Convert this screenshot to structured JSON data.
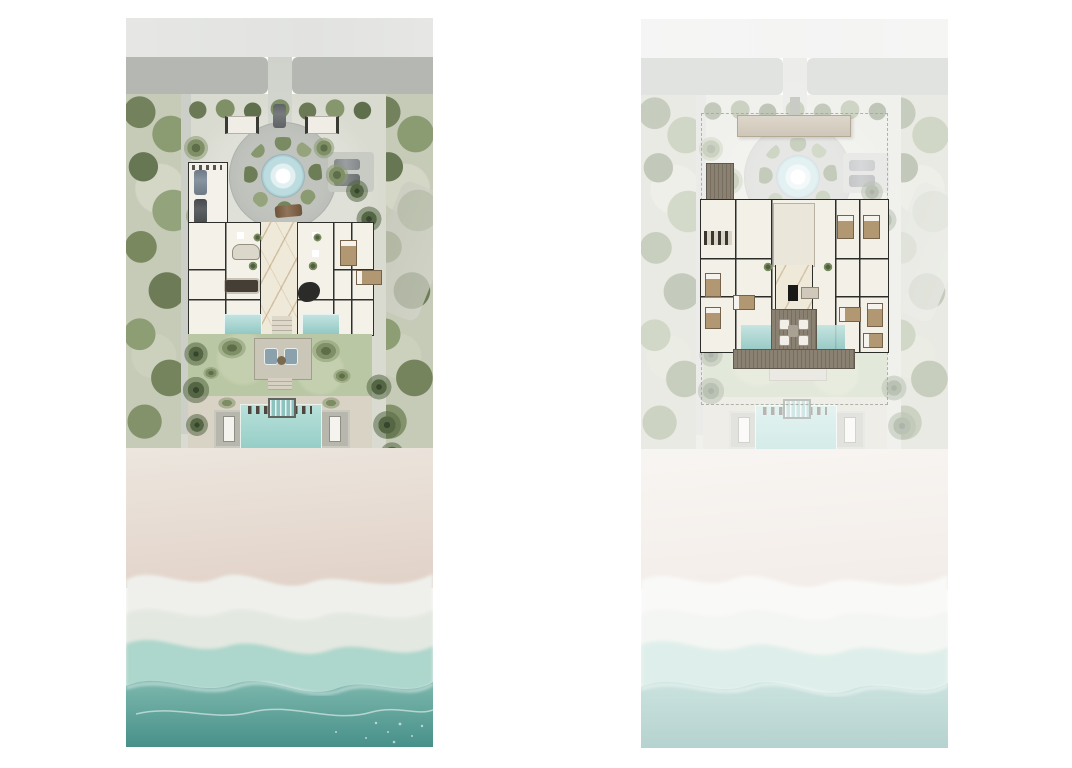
{
  "page": {
    "background": "#ffffff",
    "title": "Beachfront villa aerial site plan — ground floor and upper floor"
  },
  "panels": [
    {
      "id": "ground",
      "label": "Ground floor site plan",
      "description": "Full-colour aerial plan: access road, gated driveway, circular motor court with fountain, garage and parked cars, ground-floor villa with marble hall and reflecting pools, lawn with garden pavilion, beachfront pool with cabanas, palm trees, sand and surf."
    },
    {
      "id": "upper",
      "label": "Upper floor site plan",
      "description": "Same site shown faded with the upper-floor plan highlighted: entry canopy, timber decks, bedroom wings around the double-height hall, media room and roof terrace overlooking the pool garden; dashed property line."
    }
  ],
  "features": [
    "access-road",
    "driveway",
    "entry-gates",
    "motor-court",
    "fountain",
    "parking-pad",
    "garage",
    "villa-floorplan",
    "marble-hall",
    "reflecting-pools",
    "dining-table",
    "grand-piano",
    "bedrooms",
    "lawn",
    "garden-pavilion",
    "beach-pool",
    "spa",
    "pool-cabanas",
    "palm-trees",
    "beach-sand",
    "surf-foam",
    "ocean",
    "entry-canopy",
    "timber-decks",
    "roof-terrace",
    "property-line"
  ],
  "palette": {
    "road_band": "#b5b8b2",
    "forest": "#c6cbb8",
    "compound": "#d9dbd1",
    "paver": "#c1c4be",
    "fountain_water": "#bcdce0",
    "villa_wall": "#2f2f2b",
    "villa_floor": "#f4f1e9",
    "marble": "#efe9d9",
    "pool_teal": "#b9e0da",
    "lawn": "#bac7a4",
    "sand": "#e7dcd3",
    "foam": "#eff0ec",
    "ocean_deep": "#47908a",
    "wood": "#8a8172",
    "canopy": "#cfc7b9",
    "bed": "#b29872",
    "fade": "rgba(255,255,255,0.6)"
  }
}
